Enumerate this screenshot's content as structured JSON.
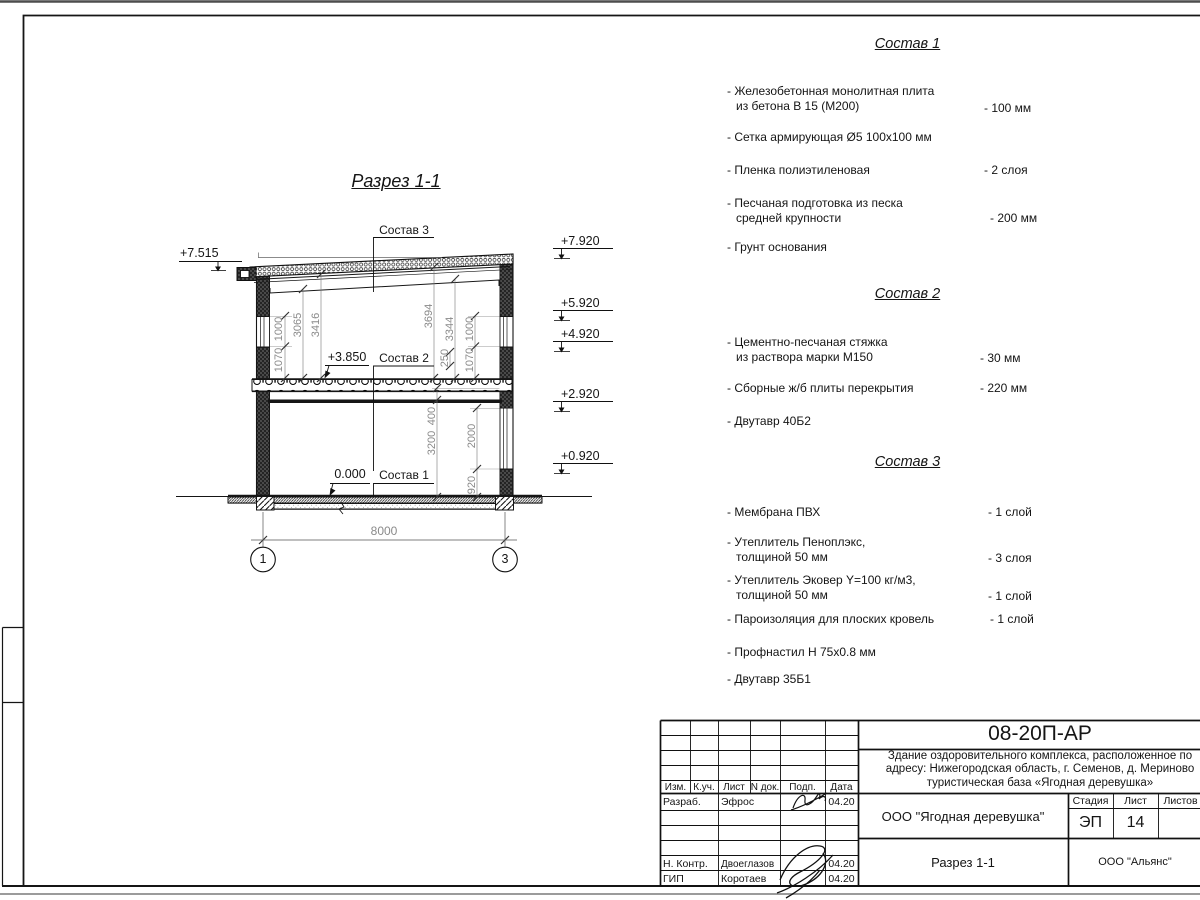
{
  "sheet": {
    "drawing_title": "Разрез 1-1",
    "elevations": {
      "left_top": "+7.515",
      "right": [
        "+7.920",
        "+5.920",
        "+4.920",
        "+2.920",
        "+0.920"
      ],
      "floor2": "+3.850",
      "floor1": "0.000"
    },
    "layer_labels": {
      "roof": "Состав 3",
      "floor2": "Состав 2",
      "floor1": "Состав 1"
    },
    "dims": {
      "l1070": "1070",
      "l1000": "1000",
      "l3065": "3065",
      "l3416": "3416",
      "r3694": "3694",
      "r3344": "3344",
      "r250": "250",
      "r1000": "1000",
      "r1070": "1070",
      "f3200": "3200",
      "f400": "400",
      "f2000": "2000",
      "f920": "920",
      "width": "8000"
    },
    "axes": {
      "left": "1",
      "right": "3"
    }
  },
  "compositions": [
    {
      "title": "Состав 1",
      "items": [
        {
          "l1": "- Железобетонная  монолитная плита",
          "l2": "из бетона В 15 (М200)",
          "value": "- 100 мм"
        },
        {
          "l1": "- Сетка армирующая Ø5 100x100 мм",
          "l2": "",
          "value": ""
        },
        {
          "l1": "- Пленка полиэтиленовая",
          "l2": "",
          "value": "-  2 слоя"
        },
        {
          "l1": "- Песчаная подготовка из песка",
          "l2": "средней крупности",
          "value": "- 200 мм"
        },
        {
          "l1": "- Грунт основания",
          "l2": "",
          "value": ""
        }
      ]
    },
    {
      "title": "Состав 2",
      "items": [
        {
          "l1": "- Цементно-песчаная стяжка",
          "l2": "из раствора марки М150",
          "value": "- 30 мм"
        },
        {
          "l1": "- Сборные ж/б плиты перекрытия",
          "l2": "",
          "value": "- 220 мм"
        },
        {
          "l1": "- Двутавр 40Б2",
          "l2": "",
          "value": ""
        }
      ]
    },
    {
      "title": "Состав 3",
      "items": [
        {
          "l1": "- Мембрана ПВХ",
          "l2": "",
          "value": "- 1 слой"
        },
        {
          "l1": "- Утеплитель Пеноплэкс,",
          "l2": "толщиной 50 мм",
          "value": "- 3 слоя"
        },
        {
          "l1": "- Утеплитель Эковер Y=100 кг/м3,",
          "l2": "толщиной 50 мм",
          "value": "- 1 слой"
        },
        {
          "l1": "- Пароизоляция для плоских кровель",
          "l2": "",
          "value": "- 1 слой"
        },
        {
          "l1": "- Профнастил Н 75x0.8 мм",
          "l2": "",
          "value": ""
        },
        {
          "l1": "- Двутавр 35Б1",
          "l2": "",
          "value": ""
        }
      ]
    }
  ],
  "title_block": {
    "code": "08-20П-АР",
    "project": [
      "Здание оздоровительного комплекса, расположенное по",
      "адресу: Нижегородская область, г. Семенов, д. Мериново",
      "туристическая база «Ягодная деревушка»"
    ],
    "columns": {
      "izm": "Изм.",
      "kuch": "К.уч.",
      "list": "Лист",
      "ndok": "N док.",
      "podp": "Подп.",
      "data": "Дата"
    },
    "rows": [
      {
        "role": "Разраб.",
        "name": "Эфрос",
        "date": "04.20"
      },
      {
        "role": "Н. Контр.",
        "name": "Двоеглазов",
        "date": "04.20"
      },
      {
        "role": "ГИП",
        "name": "Коротаев",
        "date": "04.20"
      }
    ],
    "org": "ООО \"Ягодная деревушка\"",
    "stage_label": "Стадия",
    "sheet_label": "Лист",
    "sheets_label": "Листов",
    "stage": "ЭП",
    "sheet_no": "14",
    "view_name": "Разрез 1-1",
    "company": "ООО \"Альянс\""
  }
}
